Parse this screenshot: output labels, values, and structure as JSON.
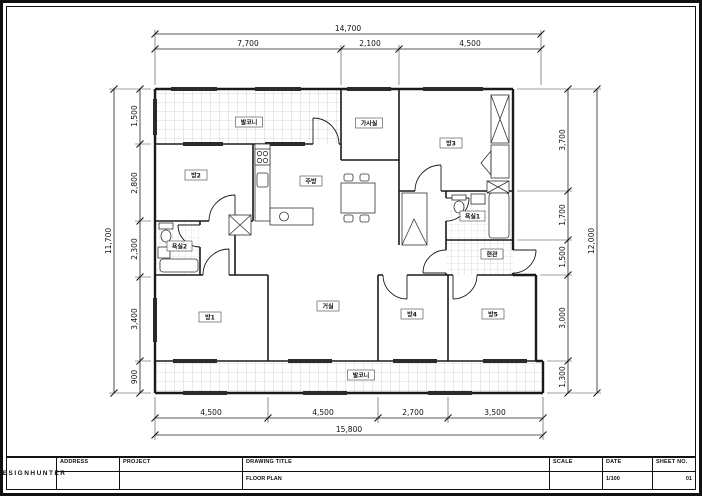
{
  "page": {
    "background": "#ffffff",
    "line_color": "#1a1a1a"
  },
  "title_block": {
    "brand": "DESIGNHUNTER",
    "labels": {
      "address": "ADDRESS",
      "project": "PROJECT",
      "drawing_title": "DRAWING TITLE",
      "scale": "SCALE",
      "date": "DATE",
      "sheet_no": "SHEET NO."
    },
    "values": {
      "drawing_title": "FLOOR PLAN",
      "scale": "1/100",
      "sheet_no": "01"
    }
  },
  "dimensions": {
    "top": {
      "overall": "14,700",
      "segments": [
        "7,700",
        "2,100",
        "4,500"
      ]
    },
    "bottom": {
      "overall": "15,800",
      "segments": [
        "4,500",
        "4,500",
        "2,700",
        "3,500"
      ]
    },
    "left": {
      "overall": "11,700",
      "segments": [
        "1,500",
        "2,800",
        "2,300",
        "3,400",
        "900"
      ]
    },
    "right": {
      "overall": "12,000",
      "segments": [
        "3,700",
        "1,700",
        "1,500",
        "3,000",
        "1,300"
      ]
    }
  },
  "rooms": {
    "balcony_top": "발코니",
    "utility_room": "가사실",
    "bedroom3": "방3",
    "bedroom2": "방2",
    "kitchen": "주방",
    "bathroom2": "욕실2",
    "bathroom1": "욕실1",
    "entrance": "현관",
    "bedroom1": "방1",
    "living_room": "거실",
    "bedroom4": "방4",
    "bedroom5": "방5",
    "balcony_bottom": "발코니"
  }
}
